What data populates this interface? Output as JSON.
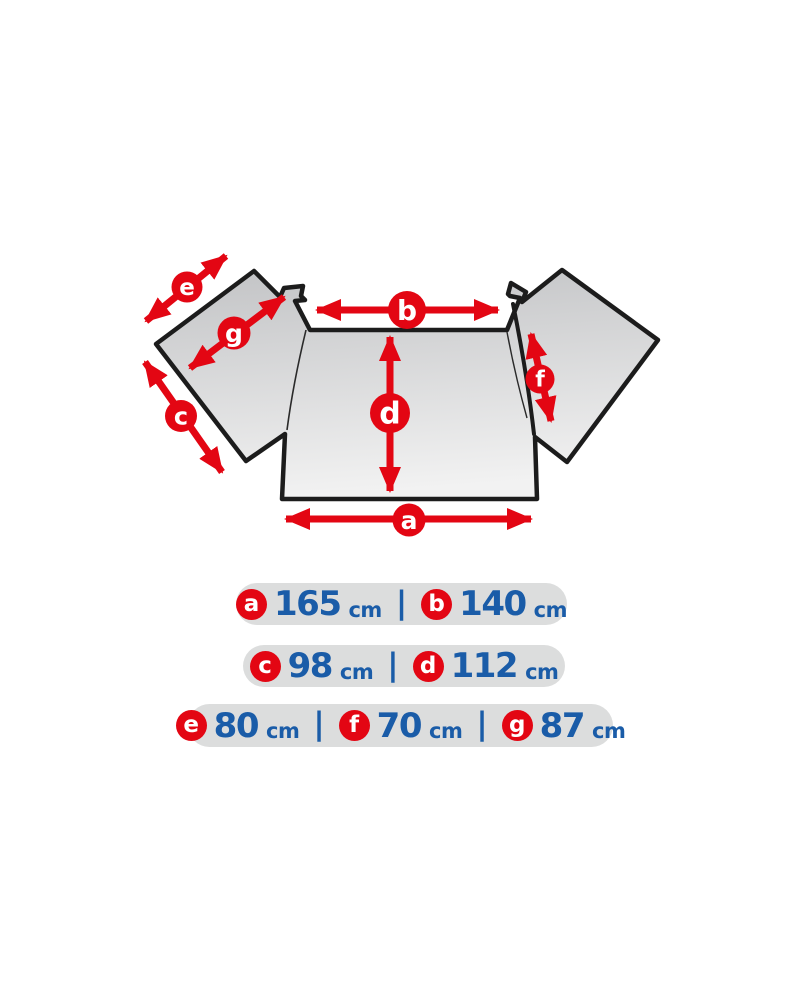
{
  "colors": {
    "red": "#e30613",
    "blue": "#1a5ca8",
    "pill-bg": "#dcdddd",
    "panel-dark": "#c3c4c6",
    "panel-light": "#f2f2f2",
    "outline": "#1c1c1c"
  },
  "diagram": {
    "marker_labels": {
      "a": "a",
      "b": "b",
      "c": "c",
      "d": "d",
      "e": "e",
      "f": "f",
      "g": "g"
    }
  },
  "measurements": [
    {
      "items": [
        {
          "label": "a",
          "value": "165",
          "unit": "cm"
        },
        {
          "label": "b",
          "value": "140",
          "unit": "cm"
        }
      ]
    },
    {
      "items": [
        {
          "label": "c",
          "value": "98",
          "unit": "cm"
        },
        {
          "label": "d",
          "value": "112",
          "unit": "cm"
        }
      ]
    },
    {
      "items": [
        {
          "label": "e",
          "value": "80",
          "unit": "cm"
        },
        {
          "label": "f",
          "value": "70",
          "unit": "cm"
        },
        {
          "label": "g",
          "value": "87",
          "unit": "cm"
        }
      ]
    }
  ],
  "ui": {
    "separator": "|"
  }
}
